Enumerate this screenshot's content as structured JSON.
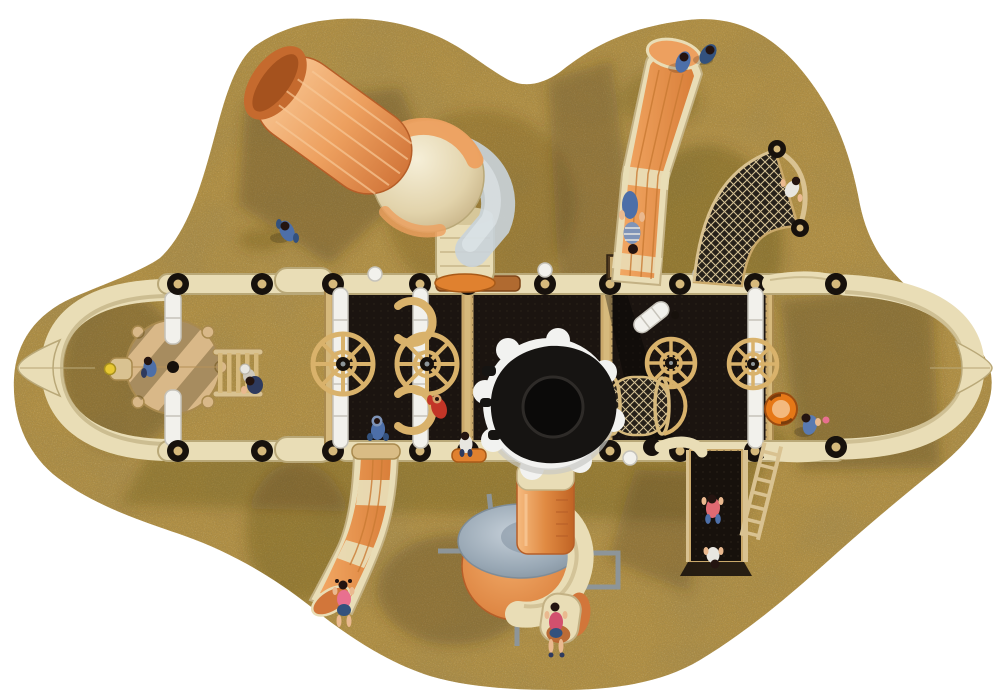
{
  "scene": {
    "description": "Top-down 3D render of a children's playground structure standing on an irregular sand island over a plain white background",
    "view": "overhead plan view",
    "background": "#ffffff"
  },
  "palette": {
    "white": "#ffffff",
    "sand": "#b08f45",
    "sandDark": "#6e5827",
    "sandLight": "#cbae62",
    "shadow": "#4a3a14",
    "cream": "#e9ddb6",
    "creamDark": "#b9a878",
    "creamEdge": "#8a7648",
    "frameTan": "#d6b97c",
    "frameDark": "#a98a4e",
    "deckBlack": "#17110c",
    "panelBlack": "#1b1410",
    "dotBrown": "#332a1e",
    "postWhite": "#f2f1ec",
    "postShade": "#c6c3ba",
    "wheelTan": "#d9b26b",
    "wheelDark": "#8a6a33",
    "orange": "#eda05f",
    "orangeLight": "#f8c896",
    "orangeDeep": "#d2763a",
    "orangeDark": "#b65e28",
    "collarOrange": "#e0812f",
    "tubeGray": "#c9d3da",
    "domeGray": "#98a7b4",
    "steel": "#8d9599",
    "spinnerRim": "#f2f2f0",
    "spinnerRimShade": "#c9c9c4",
    "spinnerBody": "#161412",
    "spinnerDish": "#0b0a09",
    "barrelOrange": "#e67817",
    "barrelSlot": "#7a3c0c",
    "barrelPale": "#f3b97e",
    "netBg": "#262019",
    "netLine": "#d3c094",
    "ladderTan": "#d9c291",
    "benchBrown": "#503a20",
    "denim": "#4d6fa8",
    "denimDark": "#33517d",
    "navy": "#2e3a5e",
    "red": "#c23527",
    "pink": "#e8708f",
    "rose": "#d2506e",
    "skin": "#eab98f",
    "hair": "#241410",
    "clothWhite": "#e8e6e0",
    "hoodBlue": "#7f94b8",
    "yellow": "#e8c832"
  },
  "equipment": {
    "sand-island": "Speckled sand safety surface island",
    "left-arch": "Cream arched end handle with pointed tip (west end)",
    "overhead-rails": "Cream overhead rails with black post joints and dome caps",
    "carousel": "Round tan spinner platform with centre hub and support post",
    "rung-bridge": "Horizontal rung ladder bridge",
    "play-deck": "Black play decks with tan frames and perforated floor",
    "steering-wheel": "Tan ship steering wheel",
    "arch-loop": "Tan loop climber on deck",
    "tube-slide": "Orange elbow tube slide with clear grey section (north-west)",
    "straight-slide": "Straight orange slide with cream rails (north-east)",
    "arc-net-climber": "Curved rope-net climber with capped rails",
    "net-tunnel": "Cylindrical rope crawl tunnel on deck",
    "telescope": "Toy telescope mounted on deck",
    "spinner-dish": "Large black spinning dish with white wavy rim",
    "spiral-slide": "Spiral tube slide with grey dome cap (south)",
    "left-slide": "Curved orange slide with cream bands (south-west)",
    "climb-ramp": "Black climbing ramp with tan rails (south-east)",
    "ladder": "Slanted tan access ladder",
    "barrel": "Orange play barrel",
    "right-arch": "Cream arched end handle with pointed tip (east end)",
    "bench-panel": "Brown panel behind the north rail"
  },
  "children": [
    {
      "id": "child-walking-nw",
      "outfit": "blue jacket and jeans",
      "activity": "walking on the sand"
    },
    {
      "id": "child-slide-top-1",
      "outfit": "denim",
      "activity": "standing at the straight slide end"
    },
    {
      "id": "child-slide-top-2",
      "outfit": "denim",
      "activity": "standing at the straight slide end"
    },
    {
      "id": "child-on-slide",
      "outfit": "striped shirt and jeans",
      "activity": "riding the straight slide"
    },
    {
      "id": "child-on-net",
      "outfit": "white shirt",
      "activity": "climbing the arc net"
    },
    {
      "id": "child-on-carousel",
      "outfit": "blue",
      "activity": "sitting on the spinner platform"
    },
    {
      "id": "child-with-cap",
      "outfit": "white cap",
      "activity": "standing by the rung bridge"
    },
    {
      "id": "child-navy",
      "outfit": "navy",
      "activity": "crouching by the rung bridge"
    },
    {
      "id": "child-blue-deck",
      "outfit": "blue hoodie",
      "activity": "playing on the deck"
    },
    {
      "id": "child-red-deck",
      "outfit": "red jacket",
      "activity": "playing on the deck"
    },
    {
      "id": "child-white-deck",
      "outfit": "white top",
      "activity": "standing at the deck edge"
    },
    {
      "id": "child-by-barrel",
      "outfit": "blue",
      "activity": "kneeling beside the barrel"
    },
    {
      "id": "child-left-slide",
      "outfit": "pink top and denim shorts",
      "activity": "sliding out of the west slide"
    },
    {
      "id": "child-spiral-exit",
      "outfit": "red top and denim skirt",
      "activity": "standing at the spiral slide exit"
    },
    {
      "id": "child-on-ramp",
      "outfit": "pink shirt",
      "activity": "climbing the ramp"
    },
    {
      "id": "child-below-ramp",
      "outfit": "white shirt",
      "activity": "standing below the ramp"
    }
  ]
}
